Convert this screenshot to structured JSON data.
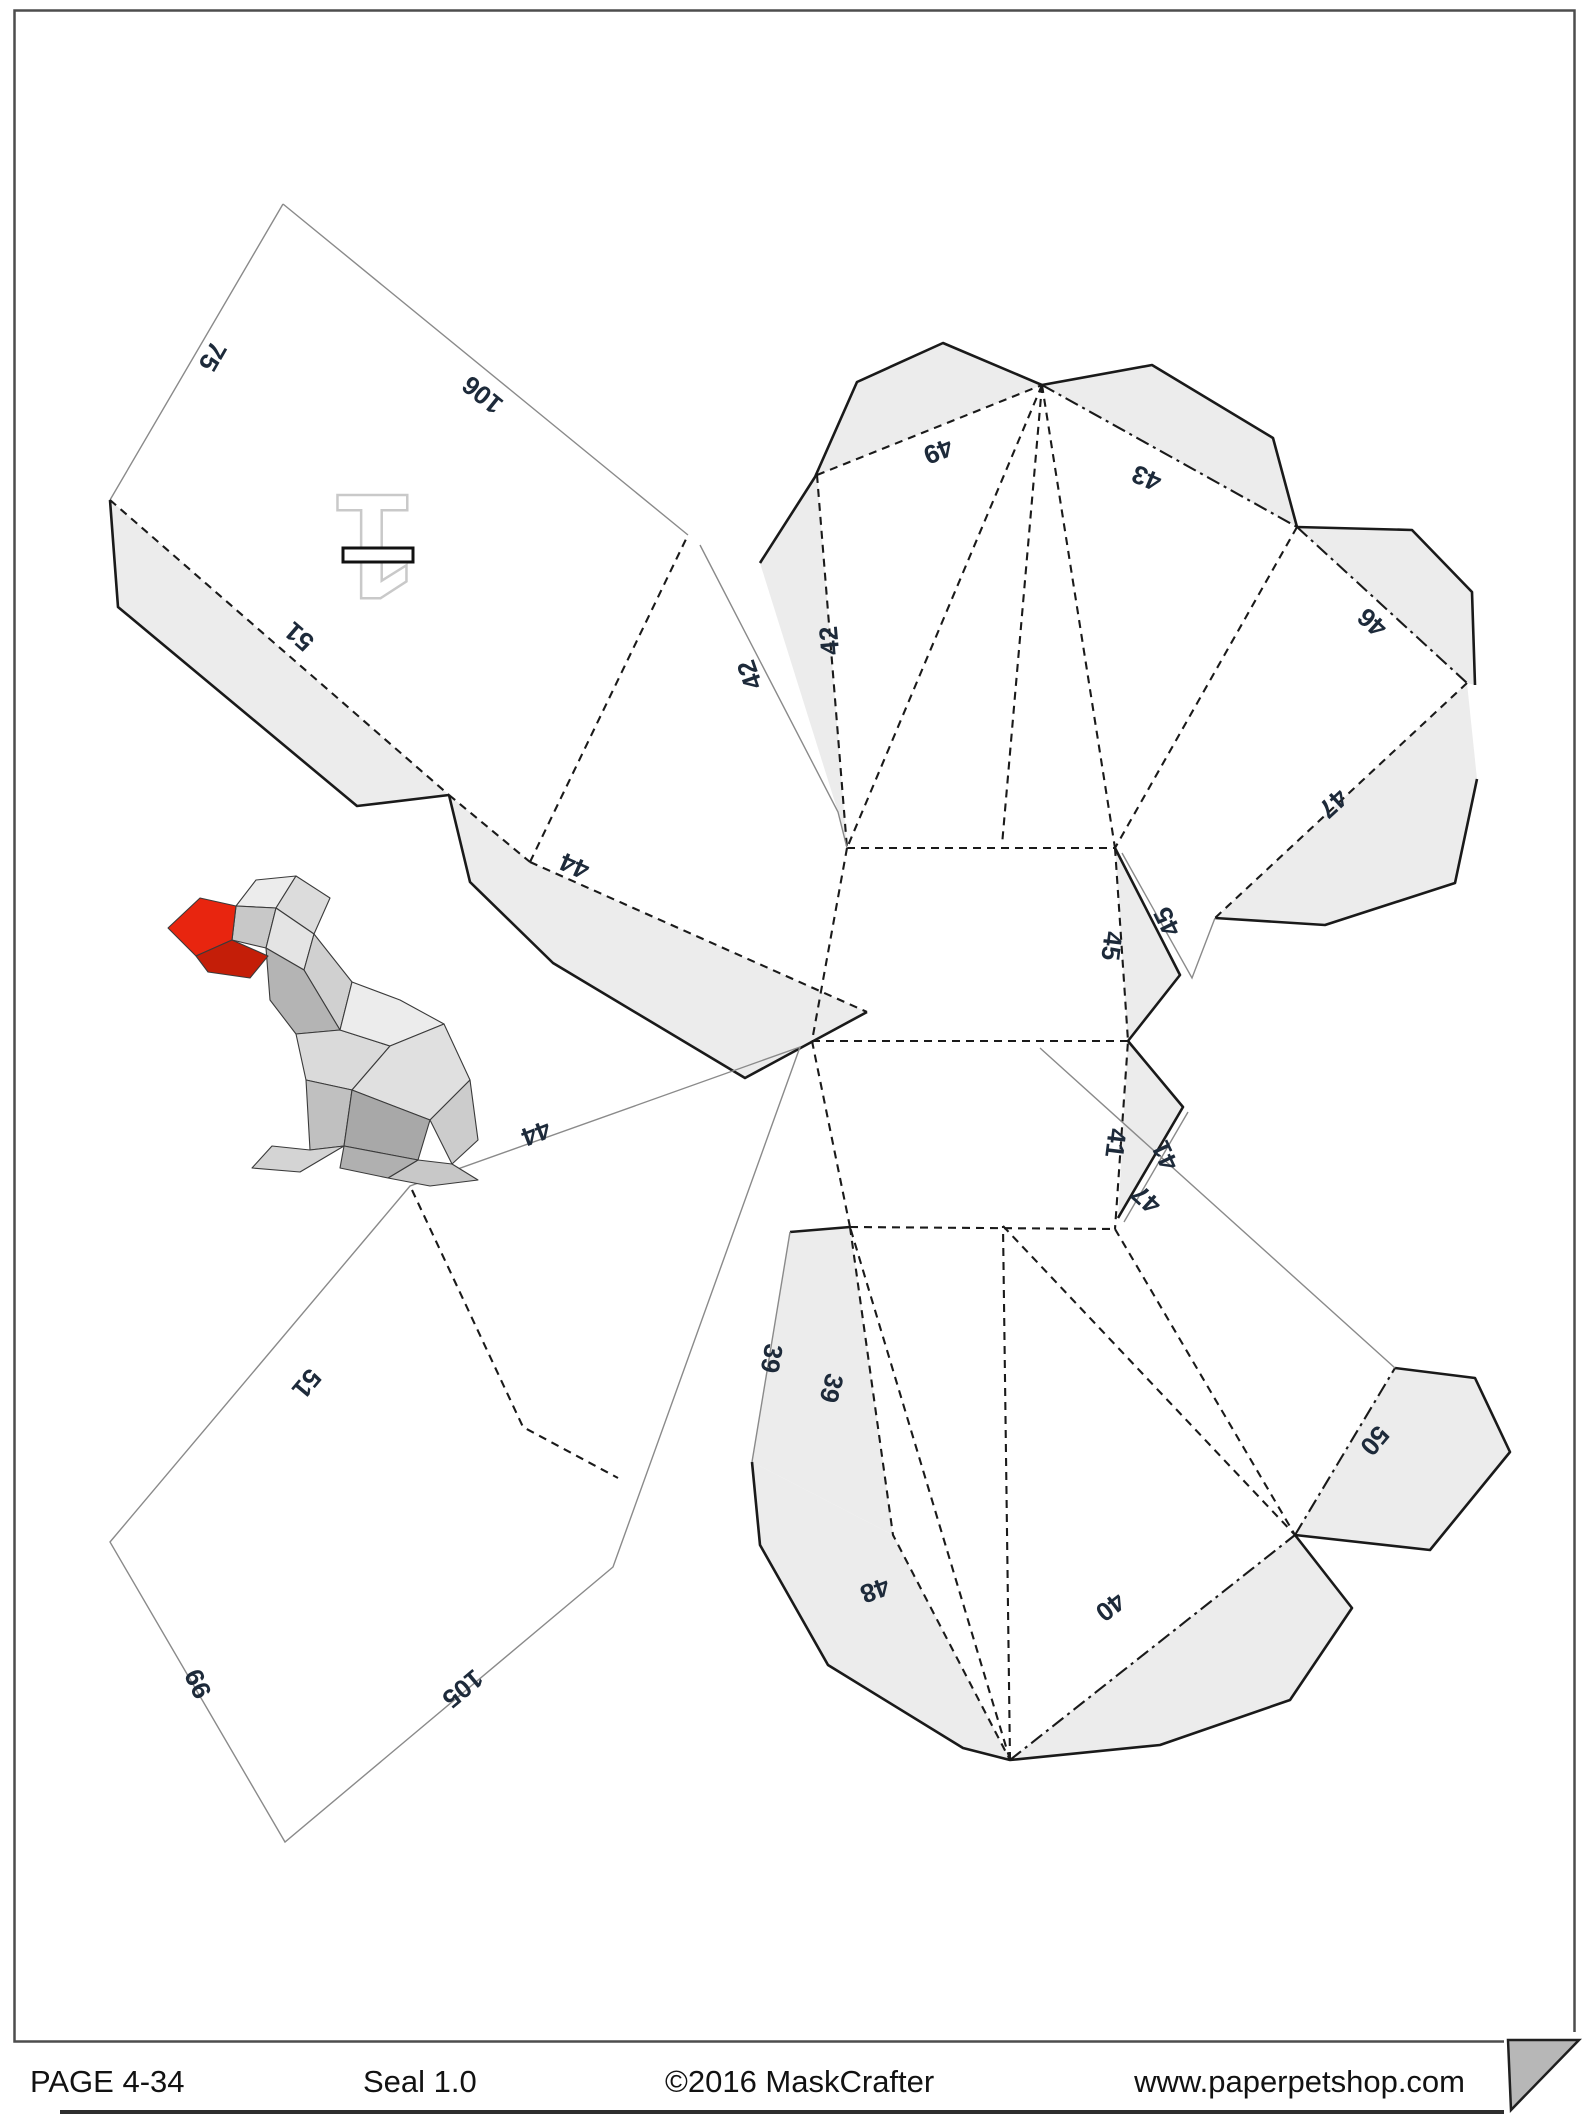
{
  "document": {
    "type_label": "papercraft unfold template page",
    "part_number": "1"
  },
  "footer": {
    "page_label": "PAGE 4-34",
    "model_label": "Seal 1.0",
    "copyright_label": "©2016 MaskCrafter",
    "website_label": "www.paperpetshop.com"
  },
  "colors": {
    "flap_fill": "#ececec",
    "cut_line": "#8a8a8a",
    "fold_line": "#1a1a1a",
    "edge_number_text": "#1d2a3a",
    "seal_red": "#e8250f",
    "fold_corner_fill": "#b7b7b7"
  },
  "pieces": [
    {
      "name": "part-1-head-panel",
      "edge_numbers": [
        {
          "value": "75",
          "x": 205,
          "y": 352,
          "rot": 120
        },
        {
          "value": "106",
          "x": 488,
          "y": 388,
          "rot": 219
        },
        {
          "value": "51",
          "x": 305,
          "y": 630,
          "rot": 221
        },
        {
          "value": "44",
          "x": 578,
          "y": 858,
          "rot": 204
        }
      ]
    },
    {
      "name": "body-pattern",
      "edge_numbers": [
        {
          "value": "49",
          "x": 935,
          "y": 443,
          "rot": 158
        },
        {
          "value": "43",
          "x": 1150,
          "y": 470,
          "rot": 203
        },
        {
          "value": "42",
          "x": 838,
          "y": 640,
          "rot": 265
        },
        {
          "value": "42",
          "x": 758,
          "y": 672,
          "rot": 251
        },
        {
          "value": "46",
          "x": 1378,
          "y": 616,
          "rot": 222
        },
        {
          "value": "47",
          "x": 1327,
          "y": 797,
          "rot": 137
        },
        {
          "value": "45",
          "x": 1103,
          "y": 945,
          "rot": 97
        },
        {
          "value": "45",
          "x": 1175,
          "y": 918,
          "rot": 244
        },
        {
          "value": "41",
          "x": 1107,
          "y": 1142,
          "rot": 97
        },
        {
          "value": "41",
          "x": 1173,
          "y": 1152,
          "rot": 245
        },
        {
          "value": "47",
          "x": 1152,
          "y": 1193,
          "rot": 222
        },
        {
          "value": "50",
          "x": 1368,
          "y": 1435,
          "rot": 130
        },
        {
          "value": "40",
          "x": 1105,
          "y": 1600,
          "rot": 142
        },
        {
          "value": "48",
          "x": 872,
          "y": 1582,
          "rot": 160
        },
        {
          "value": "39",
          "x": 763,
          "y": 1357,
          "rot": 100
        },
        {
          "value": "39",
          "x": 823,
          "y": 1386,
          "rot": 105
        }
      ]
    },
    {
      "name": "lower-left-panel",
      "edge_numbers": [
        {
          "value": "44",
          "x": 533,
          "y": 1125,
          "rot": 159
        },
        {
          "value": "51",
          "x": 300,
          "y": 1378,
          "rot": 130
        },
        {
          "value": "99",
          "x": 206,
          "y": 1680,
          "rot": 245
        },
        {
          "value": "105",
          "x": 457,
          "y": 1682,
          "rot": 140
        }
      ]
    }
  ]
}
